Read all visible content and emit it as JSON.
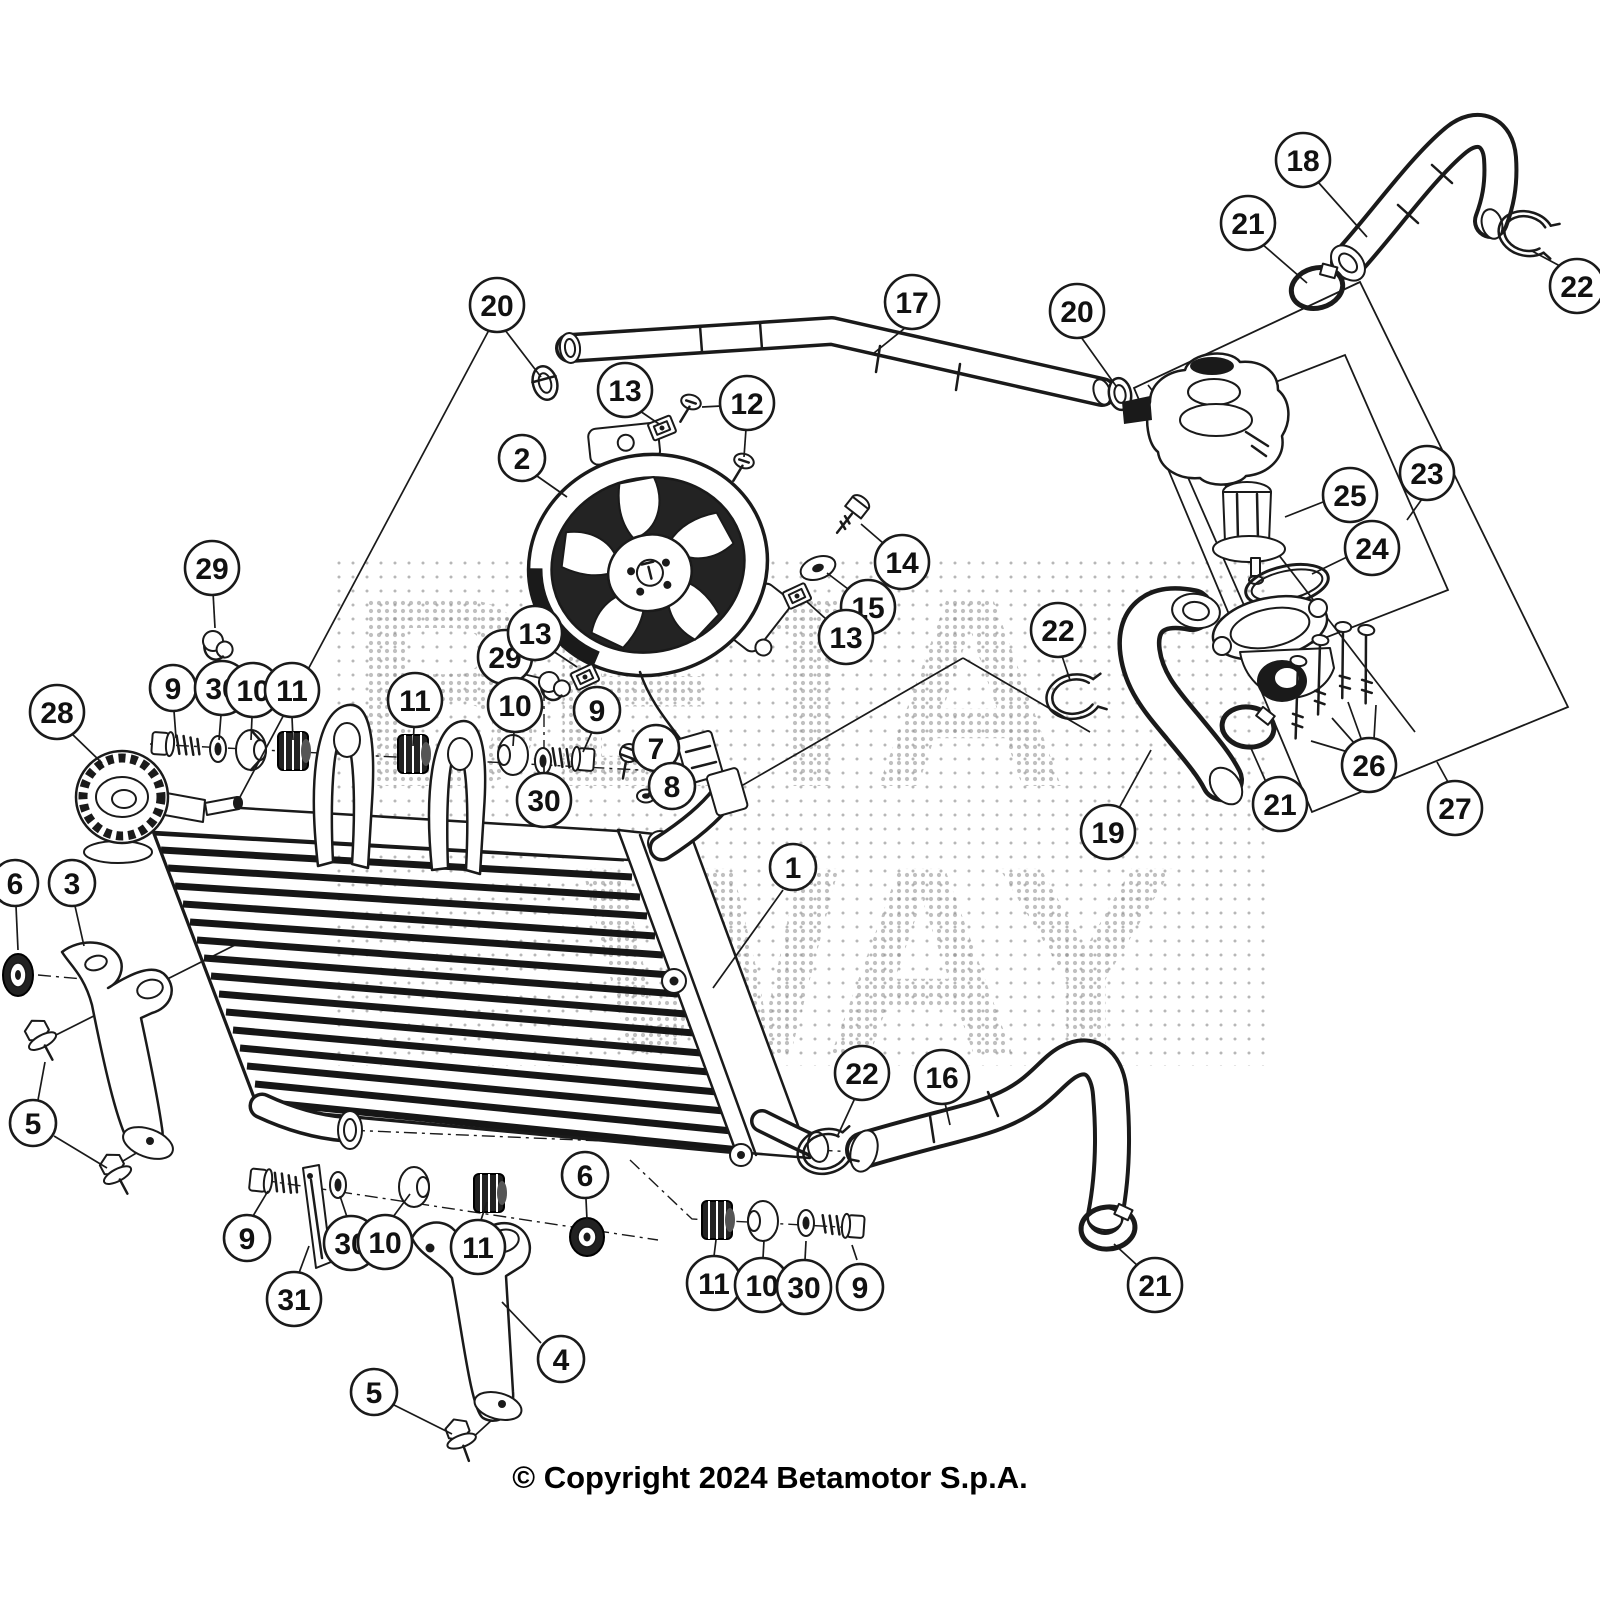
{
  "diagram": {
    "copyright": "© Copyright 2024 Betamotor S.p.A.",
    "watermark": {
      "line1": "BETA",
      "line2": "WAY"
    },
    "callouts": [
      {
        "label": "18",
        "x": 1303,
        "y": 160,
        "leaders": [
          [
            1318,
            182,
            1367,
            237
          ]
        ]
      },
      {
        "label": "21",
        "x": 1248,
        "y": 223,
        "leaders": [
          [
            1262,
            244,
            1307,
            283
          ]
        ]
      },
      {
        "label": "22",
        "x": 1577,
        "y": 286,
        "leaders": [
          [
            1560,
            266,
            1532,
            251
          ]
        ]
      },
      {
        "label": "17",
        "x": 912,
        "y": 302,
        "leaders": [
          [
            905,
            328,
            874,
            353
          ]
        ]
      },
      {
        "label": "20",
        "x": 497,
        "y": 305,
        "leaders": [
          [
            505,
            330,
            541,
            377
          ],
          [
            489,
            330,
            240,
            797
          ]
        ]
      },
      {
        "label": "20",
        "x": 1077,
        "y": 311,
        "leaders": [
          [
            1081,
            337,
            1116,
            386
          ]
        ]
      },
      {
        "label": "13",
        "x": 625,
        "y": 390,
        "leaders": [
          [
            640,
            411,
            659,
            424
          ]
        ]
      },
      {
        "label": "12",
        "x": 747,
        "y": 403,
        "leaders": [
          [
            721,
            406,
            702,
            407
          ],
          [
            746,
            429,
            744,
            457
          ]
        ]
      },
      {
        "label": "2",
        "x": 522,
        "y": 458,
        "leaders": [
          [
            537,
            476,
            567,
            497
          ]
        ]
      },
      {
        "label": "14",
        "x": 902,
        "y": 562,
        "leaders": [
          [
            883,
            543,
            861,
            524
          ]
        ]
      },
      {
        "label": "15",
        "x": 868,
        "y": 607,
        "leaders": [
          [
            848,
            589,
            827,
            573
          ]
        ]
      },
      {
        "label": "13",
        "x": 846,
        "y": 637,
        "leaders": [
          [
            826,
            619,
            806,
            601
          ]
        ]
      },
      {
        "label": "25",
        "x": 1350,
        "y": 495,
        "leaders": [
          [
            1323,
            502,
            1285,
            517
          ]
        ]
      },
      {
        "label": "23",
        "x": 1427,
        "y": 473,
        "leaders": [
          [
            1422,
            499,
            1407,
            520
          ]
        ]
      },
      {
        "label": "24",
        "x": 1372,
        "y": 548,
        "leaders": [
          [
            1347,
            557,
            1312,
            574
          ]
        ]
      },
      {
        "label": "29",
        "x": 212,
        "y": 568,
        "leaders": [
          [
            213,
            592,
            215,
            628
          ]
        ]
      },
      {
        "label": "28",
        "x": 57,
        "y": 712,
        "leaders": [
          [
            71,
            733,
            102,
            763
          ]
        ]
      },
      {
        "label": "9",
        "x": 173,
        "y": 688,
        "leaders": [
          [
            174,
            711,
            176,
            738
          ]
        ]
      },
      {
        "label": "30",
        "x": 222,
        "y": 688,
        "leaders": [
          [
            221,
            715,
            219,
            740
          ]
        ]
      },
      {
        "label": "10",
        "x": 253,
        "y": 690,
        "leaders": [
          [
            252,
            717,
            251,
            740
          ]
        ]
      },
      {
        "label": "11",
        "x": 292,
        "y": 690,
        "leaders": [
          [
            292,
            717,
            293,
            740
          ]
        ]
      },
      {
        "label": "11",
        "x": 415,
        "y": 700,
        "leaders": [
          [
            414,
            727,
            413,
            746
          ]
        ]
      },
      {
        "label": "29",
        "x": 505,
        "y": 657,
        "leaders": [
          [
            523,
            674,
            540,
            678
          ]
        ]
      },
      {
        "label": "13",
        "x": 535,
        "y": 633,
        "leaders": [
          [
            553,
            651,
            577,
            667
          ]
        ]
      },
      {
        "label": "10",
        "x": 515,
        "y": 705,
        "leaders": [
          [
            514,
            732,
            513,
            746
          ]
        ]
      },
      {
        "label": "9",
        "x": 597,
        "y": 710,
        "leaders": [
          [
            592,
            732,
            583,
            752
          ]
        ]
      },
      {
        "label": "30",
        "x": 544,
        "y": 800,
        "leaders": [
          [
            544,
            776,
            544,
            764
          ]
        ]
      },
      {
        "label": "7",
        "x": 656,
        "y": 748,
        "leaders": [
          [
            637,
            762,
            630,
            758
          ]
        ]
      },
      {
        "label": "8",
        "x": 672,
        "y": 786,
        "leaders": [
          [
            650,
            792,
            648,
            794
          ]
        ]
      },
      {
        "label": "22",
        "x": 1058,
        "y": 630,
        "leaders": [
          [
            1062,
            656,
            1070,
            680
          ]
        ]
      },
      {
        "label": "6",
        "x": 15,
        "y": 883,
        "leaders": [
          [
            16,
            906,
            18,
            950
          ]
        ]
      },
      {
        "label": "3",
        "x": 72,
        "y": 883,
        "leaders": [
          [
            75,
            906,
            84,
            946
          ]
        ]
      },
      {
        "label": "1",
        "x": 793,
        "y": 867,
        "leaders": [
          [
            783,
            890,
            713,
            988
          ]
        ]
      },
      {
        "label": "19",
        "x": 1108,
        "y": 832,
        "leaders": [
          [
            1118,
            810,
            1151,
            750
          ]
        ]
      },
      {
        "label": "21",
        "x": 1280,
        "y": 804,
        "leaders": [
          [
            1266,
            782,
            1250,
            746
          ]
        ]
      },
      {
        "label": "26",
        "x": 1369,
        "y": 765,
        "leaders": [
          [
            1348,
            752,
            1311,
            741
          ],
          [
            1355,
            744,
            1332,
            718
          ],
          [
            1362,
            741,
            1348,
            702
          ],
          [
            1374,
            739,
            1376,
            705
          ]
        ]
      },
      {
        "label": "27",
        "x": 1455,
        "y": 808,
        "leaders": [
          [
            1448,
            782,
            1437,
            762
          ]
        ]
      },
      {
        "label": "5",
        "x": 33,
        "y": 1123,
        "leaders": [
          [
            38,
            1100,
            45,
            1062
          ],
          [
            54,
            1136,
            107,
            1168
          ]
        ]
      },
      {
        "label": "22",
        "x": 862,
        "y": 1073,
        "leaders": [
          [
            855,
            1098,
            837,
            1137
          ]
        ]
      },
      {
        "label": "16",
        "x": 942,
        "y": 1077,
        "leaders": [
          [
            945,
            1103,
            950,
            1125
          ]
        ]
      },
      {
        "label": "9",
        "x": 247,
        "y": 1238,
        "leaders": [
          [
            253,
            1216,
            268,
            1191
          ]
        ]
      },
      {
        "label": "31",
        "x": 294,
        "y": 1299,
        "leaders": [
          [
            299,
            1273,
            309,
            1246
          ]
        ]
      },
      {
        "label": "30",
        "x": 351,
        "y": 1243,
        "leaders": [
          [
            347,
            1217,
            340,
            1196
          ]
        ]
      },
      {
        "label": "10",
        "x": 385,
        "y": 1242,
        "leaders": [
          [
            393,
            1217,
            410,
            1194
          ]
        ]
      },
      {
        "label": "11",
        "x": 478,
        "y": 1247,
        "leaders": [
          [
            481,
            1220,
            487,
            1202
          ]
        ]
      },
      {
        "label": "6",
        "x": 585,
        "y": 1175,
        "leaders": [
          [
            586,
            1199,
            587,
            1220
          ]
        ]
      },
      {
        "label": "4",
        "x": 561,
        "y": 1359,
        "leaders": [
          [
            541,
            1343,
            502,
            1302
          ]
        ]
      },
      {
        "label": "5",
        "x": 374,
        "y": 1392,
        "leaders": [
          [
            394,
            1405,
            452,
            1434
          ]
        ]
      },
      {
        "label": "11",
        "x": 714,
        "y": 1283,
        "leaders": [
          [
            714,
            1256,
            716,
            1240
          ]
        ]
      },
      {
        "label": "10",
        "x": 762,
        "y": 1285,
        "leaders": [
          [
            763,
            1258,
            764,
            1240
          ]
        ]
      },
      {
        "label": "30",
        "x": 804,
        "y": 1287,
        "leaders": [
          [
            805,
            1260,
            806,
            1241
          ]
        ]
      },
      {
        "label": "9",
        "x": 860,
        "y": 1287,
        "leaders": [
          [
            857,
            1260,
            852,
            1245
          ]
        ]
      },
      {
        "label": "21",
        "x": 1155,
        "y": 1285,
        "leaders": [
          [
            1138,
            1266,
            1114,
            1244
          ]
        ]
      }
    ],
    "construction": {
      "lines": [
        [
          717,
          800,
          963,
          658
        ],
        [
          963,
          658,
          1090,
          732
        ],
        [
          1148,
          385,
          1415,
          732
        ],
        [
          50,
          1038,
          235,
          945
        ],
        [
          113,
          1167,
          148,
          1146
        ],
        [
          470,
          1440,
          505,
          1408
        ]
      ],
      "boxes": [
        [
          1134,
          388,
          1360,
          282,
          1568,
          707,
          1312,
          812
        ],
        [
          1165,
          425,
          1345,
          355,
          1448,
          590,
          1268,
          660
        ]
      ],
      "axes": [
        [
          150,
          744,
          640,
          770
        ],
        [
          544,
          688,
          544,
          758
        ],
        [
          262,
          1180,
          658,
          1240
        ],
        [
          630,
          1160,
          692,
          1219,
          858,
          1228
        ],
        [
          300,
          1128,
          860,
          1152
        ],
        [
          38,
          975,
          150,
          985
        ]
      ]
    }
  }
}
